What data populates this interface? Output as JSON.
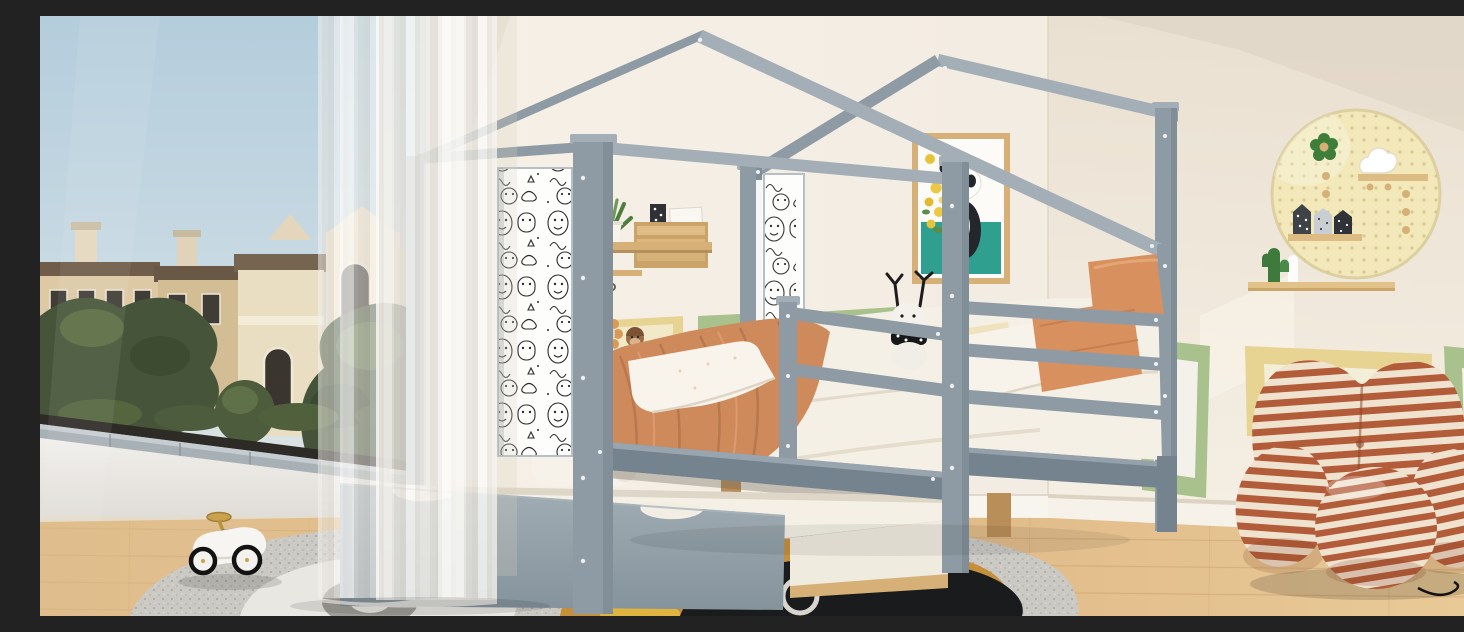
{
  "scene": {
    "title": "Kids bedroom with gray wooden house-frame bed and pull-out trundle",
    "description": "Product photo of a gray house-shaped twin bed with doodle-print panels, guardrails and a trundle drawer, set in a bright child's room with a balcony window view of classical buildings, sheer curtains, a panda poster, a wooden wall shelf with a plant, a round yellow pegboard with decorations, a striped heart chair with ball ottoman, a play rug with a white toy ride-on car, and framed pictures leaning against the wall.",
    "regions": {
      "window_view": {
        "label": "Floor-to-ceiling balcony window",
        "items": [
          "blue sky",
          "classical beige buildings with chimneys",
          "green trees",
          "white balcony parapet with stone coping"
        ]
      },
      "curtain": {
        "label": "Sheer white curtain panel"
      },
      "bed": {
        "label": "Gray wooden house bed",
        "features": [
          "double gable roof beams",
          "doodle-print side panels",
          "three-slat guardrail",
          "wooden legs",
          "pull-out trundle drawer with scalloped handles"
        ],
        "bedding": [
          "terracotta blanket",
          "white floral pillow",
          "cream pillow",
          "white pillows",
          "two orange pillows",
          "white fitted sheet"
        ],
        "plush_toys": [
          "white reindeer plush with black antlers and dotted scarf",
          "lion plush",
          "monkey plush"
        ]
      },
      "wall_decor": {
        "items": [
          "wooden wall shelf with green plant, crate organizer and key hooks",
          "panda poster with yellow flowers and teal block",
          "yellow wainscot panel",
          "green wainscot panels",
          "leaning green picture frames",
          "leaning yellow picture frame"
        ]
      },
      "pegboard": {
        "label": "Round pale-yellow pegboard",
        "items": [
          "green flower decor",
          "white cloud decor",
          "two small wooden shelves",
          "three patterned house boxes",
          "green cactus cutout",
          "wooden pegs",
          "long wooden wall shelf"
        ]
      },
      "chair": {
        "label": "Rust-and-cream striped heart lounge chair",
        "ottoman": "striped ball ottoman"
      },
      "rug": {
        "label": "Round speckled gray play rug with gold, white and black animal shapes"
      },
      "toy_car": {
        "label": "White vintage ride-on toy car with gold steering wheel"
      }
    }
  },
  "colors": {
    "wallCream": "#f3ece2",
    "wallShade": "#e7ddcf",
    "wallRight": "#efe7da",
    "bedGray": "#8e9ba4",
    "bedGrayLight": "#a3aeb6",
    "bedGrayDark": "#75838e",
    "trundleGray": "#95a2ab",
    "floorWood": "#dcb483",
    "floorWoodLight": "#e9cb97",
    "plankLine": "#c79e6a",
    "sky": "#bed3de",
    "building": "#ddc9a4",
    "buildingLight": "#e9ddc2",
    "roofBrown": "#6f5c49",
    "windowDark": "#3d3933",
    "treeGreen": "#46553a",
    "treeGreenDark": "#39482e",
    "treeGreenLight": "#66794a",
    "copingGray": "#a7b0b5",
    "parapetWhite": "#eceae6",
    "curtainWhite": "#f7f5f1",
    "blanketTerracotta": "#cf8a5c",
    "blanketShade": "#b3744a",
    "pillowOrange": "#d8905f",
    "linenWhite": "#f5f0e6",
    "pegboardYellow": "#f2e8ba",
    "pegHole": "#d8c88f",
    "cactusGreen": "#3d7a3c",
    "flowerGreen": "#3e7d3a",
    "wood": "#d6b077",
    "woodDark": "#b98e58",
    "chairRust": "#b35c39",
    "chairCream": "#efe2cf",
    "rugBase": "#cbc9c4",
    "rugGold": "#c68f3a",
    "rugBlack": "#1a1b1d",
    "rugWhite": "#e9e7e2",
    "posterTeal": "#2f9f90",
    "frameGreen": "#a9c18c",
    "frameYellow": "#e7d493",
    "pandaBlack": "#23262b",
    "doodleInk": "#2b2b2b",
    "nightstandWhite": "#f6f2e9",
    "toyGold": "#caa24e"
  }
}
